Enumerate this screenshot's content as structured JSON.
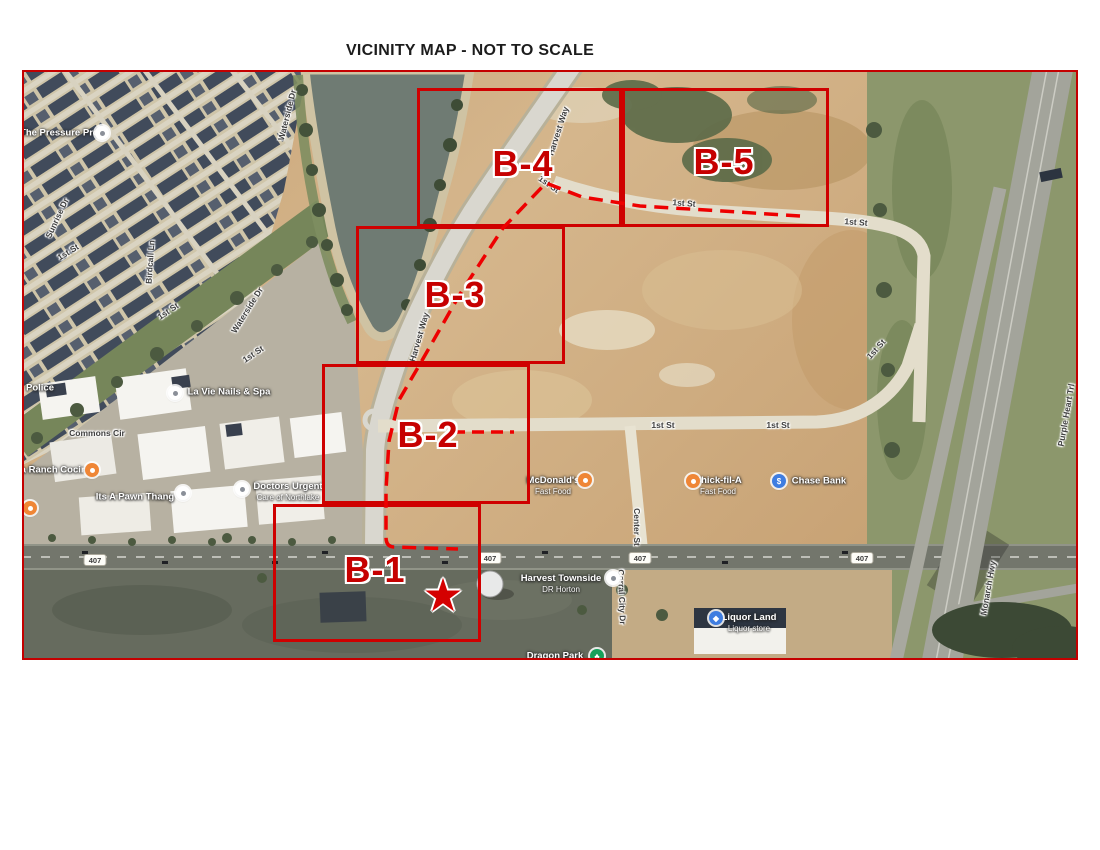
{
  "title": "VICINITY MAP - NOT TO SCALE",
  "map": {
    "border_color": "#c40000",
    "overlay_color": "#e00000",
    "box_label_color": "#c60000"
  },
  "boxes": [
    {
      "id": "B-1",
      "label": "B-1",
      "x": 251,
      "y": 434,
      "w": 208,
      "h": 138,
      "label_x": 353,
      "label_y": 500
    },
    {
      "id": "B-2",
      "label": "B-2",
      "x": 300,
      "y": 294,
      "w": 208,
      "h": 140,
      "label_x": 406,
      "label_y": 365
    },
    {
      "id": "B-3",
      "label": "B-3",
      "x": 334,
      "y": 156,
      "w": 209,
      "h": 138,
      "label_x": 433,
      "label_y": 225
    },
    {
      "id": "B-4",
      "label": "B-4",
      "x": 395,
      "y": 18,
      "w": 205,
      "h": 139,
      "label_x": 501,
      "label_y": 94
    },
    {
      "id": "B-5",
      "label": "B-5",
      "x": 600,
      "y": 18,
      "w": 207,
      "h": 139,
      "label_x": 702,
      "label_y": 92
    }
  ],
  "star": {
    "glyph": "★",
    "x": 421,
    "y": 527
  },
  "dashes": {
    "main": "M778 146 L700 141 L618 136 L560 127 L524 113 L481 158 L438 224 L398 294 L377 330 L367 371 L364 420 L364 467 Q364 477 372 477 L436 479",
    "b2": "M431 362 L492 362"
  },
  "shields": [
    {
      "text": "407",
      "x": 73,
      "y": 490
    },
    {
      "text": "407",
      "x": 468,
      "y": 488
    },
    {
      "text": "407",
      "x": 618,
      "y": 488
    },
    {
      "text": "407",
      "x": 840,
      "y": 488
    }
  ],
  "street_labels": [
    {
      "text": "Sunrise Dr",
      "x": 35,
      "y": 148,
      "rot": -65
    },
    {
      "text": "1st St",
      "x": 46,
      "y": 182,
      "rot": -32
    },
    {
      "text": "Birdcall Ln",
      "x": 128,
      "y": 192,
      "rot": -86
    },
    {
      "text": "Waterside Dr",
      "x": 265,
      "y": 45,
      "rot": -76
    },
    {
      "text": "Waterside Dr",
      "x": 225,
      "y": 240,
      "rot": -58
    },
    {
      "text": "1st St",
      "x": 146,
      "y": 241,
      "rot": -34
    },
    {
      "text": "1st St",
      "x": 231,
      "y": 284,
      "rot": -34
    },
    {
      "text": "Commons Cir",
      "x": 75,
      "y": 363,
      "rot": 0
    },
    {
      "text": "Harvest Way",
      "x": 536,
      "y": 61,
      "rot": -72
    },
    {
      "text": "Harvest Way",
      "x": 397,
      "y": 267,
      "rot": -74
    },
    {
      "text": "1st St",
      "x": 527,
      "y": 114,
      "rot": 35
    },
    {
      "text": "1st St",
      "x": 662,
      "y": 133,
      "rot": 4
    },
    {
      "text": "1st St",
      "x": 834,
      "y": 152,
      "rot": 4
    },
    {
      "text": "1st St",
      "x": 641,
      "y": 355,
      "rot": 0
    },
    {
      "text": "1st St",
      "x": 756,
      "y": 355,
      "rot": 0
    },
    {
      "text": "1st St",
      "x": 854,
      "y": 279,
      "rot": -48
    },
    {
      "text": "Center St",
      "x": 615,
      "y": 457,
      "rot": 90
    },
    {
      "text": "Corral City Dr",
      "x": 600,
      "y": 527,
      "rot": 88
    },
    {
      "text": "Monarch Hwy",
      "x": 966,
      "y": 518,
      "rot": -80
    },
    {
      "text": "Purple Heart Trl",
      "x": 1044,
      "y": 345,
      "rot": -80
    }
  ],
  "pois": [
    {
      "lines": [
        "The Pressure Pros"
      ],
      "text_x": 40,
      "text_y": 63,
      "pin": "white",
      "glyph": "",
      "pin_x": 80,
      "pin_y": 63
    },
    {
      "lines": [
        "Police"
      ],
      "text_x": 18,
      "text_y": 318,
      "pin": "",
      "glyph": "",
      "pin_x": 0,
      "pin_y": 0
    },
    {
      "lines": [
        "La Vie Nails & Spa"
      ],
      "text_x": 207,
      "text_y": 322,
      "pin": "white",
      "glyph": "",
      "pin_x": 153,
      "pin_y": 323
    },
    {
      "lines": [
        "la Ranch Cocina"
      ],
      "text_x": 33,
      "text_y": 400,
      "pin": "orange",
      "glyph": "",
      "pin_x": 70,
      "pin_y": 400
    },
    {
      "lines": [
        "Its A Pawn Thang"
      ],
      "text_x": 113,
      "text_y": 427,
      "pin": "white",
      "glyph": "",
      "pin_x": 161,
      "pin_y": 423
    },
    {
      "lines": [
        "Doctors Urgent",
        "Care of Northlake"
      ],
      "text_x": 266,
      "text_y": 422,
      "pin": "white",
      "glyph": "",
      "pin_x": 220,
      "pin_y": 419
    },
    {
      "lines": [
        "McDonald's",
        "Fast Food"
      ],
      "text_x": 531,
      "text_y": 416,
      "pin": "orange",
      "glyph": "",
      "pin_x": 563,
      "pin_y": 410
    },
    {
      "lines": [
        "Chick-fil-A",
        "Fast Food"
      ],
      "text_x": 696,
      "text_y": 416,
      "pin": "orange",
      "glyph": "",
      "pin_x": 671,
      "pin_y": 411
    },
    {
      "lines": [
        "Chase Bank"
      ],
      "text_x": 797,
      "text_y": 411,
      "pin": "blue",
      "glyph": "$",
      "pin_x": 757,
      "pin_y": 411
    },
    {
      "lines": [
        "Harvest Townside",
        "DR Horton"
      ],
      "text_x": 539,
      "text_y": 514,
      "pin": "white",
      "glyph": "",
      "pin_x": 591,
      "pin_y": 508
    },
    {
      "lines": [
        "Liquor Land",
        "Liquor store"
      ],
      "text_x": 727,
      "text_y": 553,
      "pin": "blue",
      "glyph": "◆",
      "pin_x": 694,
      "pin_y": 548
    },
    {
      "lines": [
        "Dragon Park"
      ],
      "text_x": 533,
      "text_y": 586,
      "pin": "green",
      "glyph": "♣",
      "pin_x": 575,
      "pin_y": 586
    },
    {
      "lines": [],
      "text_x": 0,
      "text_y": 0,
      "pin": "orange",
      "glyph": "",
      "pin_x": 8,
      "pin_y": 438
    }
  ]
}
